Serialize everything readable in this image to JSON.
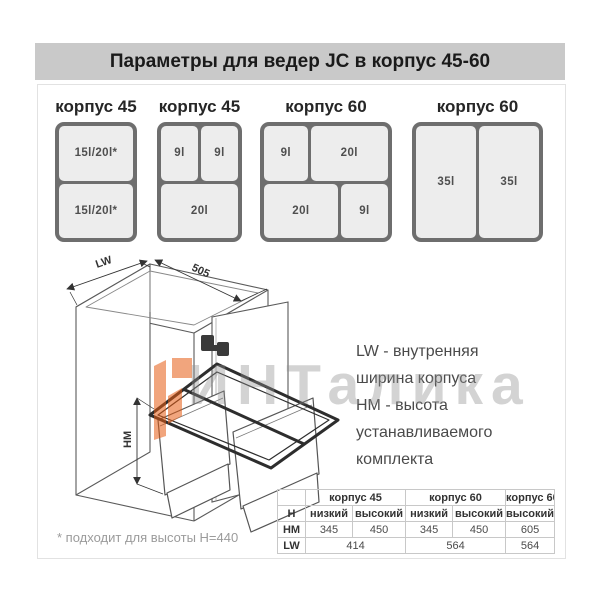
{
  "title": "Параметры для ведер JC в корпус 45-60",
  "diagrams": [
    {
      "title": "корпус 45",
      "cells": [
        "15l/20l*",
        "15l/20l*"
      ]
    },
    {
      "title": "корпус 45",
      "cells": [
        "9l",
        "9l",
        "20l"
      ]
    },
    {
      "title": "корпус 60",
      "cells": [
        "9l",
        "20l",
        "20l",
        "9l"
      ]
    },
    {
      "title": "корпус 60",
      "cells": [
        "35l",
        "35l"
      ]
    }
  ],
  "drawing": {
    "dims": {
      "width_label": "LW",
      "depth_label": "505",
      "height_label": "HM"
    }
  },
  "legend": {
    "lines": [
      "LW - внутренняя",
      "ширина корпуса",
      "HM - высота",
      "устанавливаемого",
      "комплекта"
    ]
  },
  "watermark": {
    "text": "ИНТалика",
    "accent_color": "#e65c13",
    "text_color": "#8e8e8e"
  },
  "table": {
    "group_headers": [
      "корпус 45",
      "корпус 60",
      "корпус 60"
    ],
    "rows": [
      {
        "label": "H",
        "values": [
          "низкий",
          "высокий",
          "низкий",
          "высокий",
          "высокий 35l"
        ]
      },
      {
        "label": "HM",
        "values": [
          "345",
          "450",
          "345",
          "450",
          "605"
        ]
      },
      {
        "label": "LW",
        "values": [
          "414",
          "564",
          "564"
        ]
      }
    ]
  },
  "footnote": "* подходит для высоты H=440"
}
